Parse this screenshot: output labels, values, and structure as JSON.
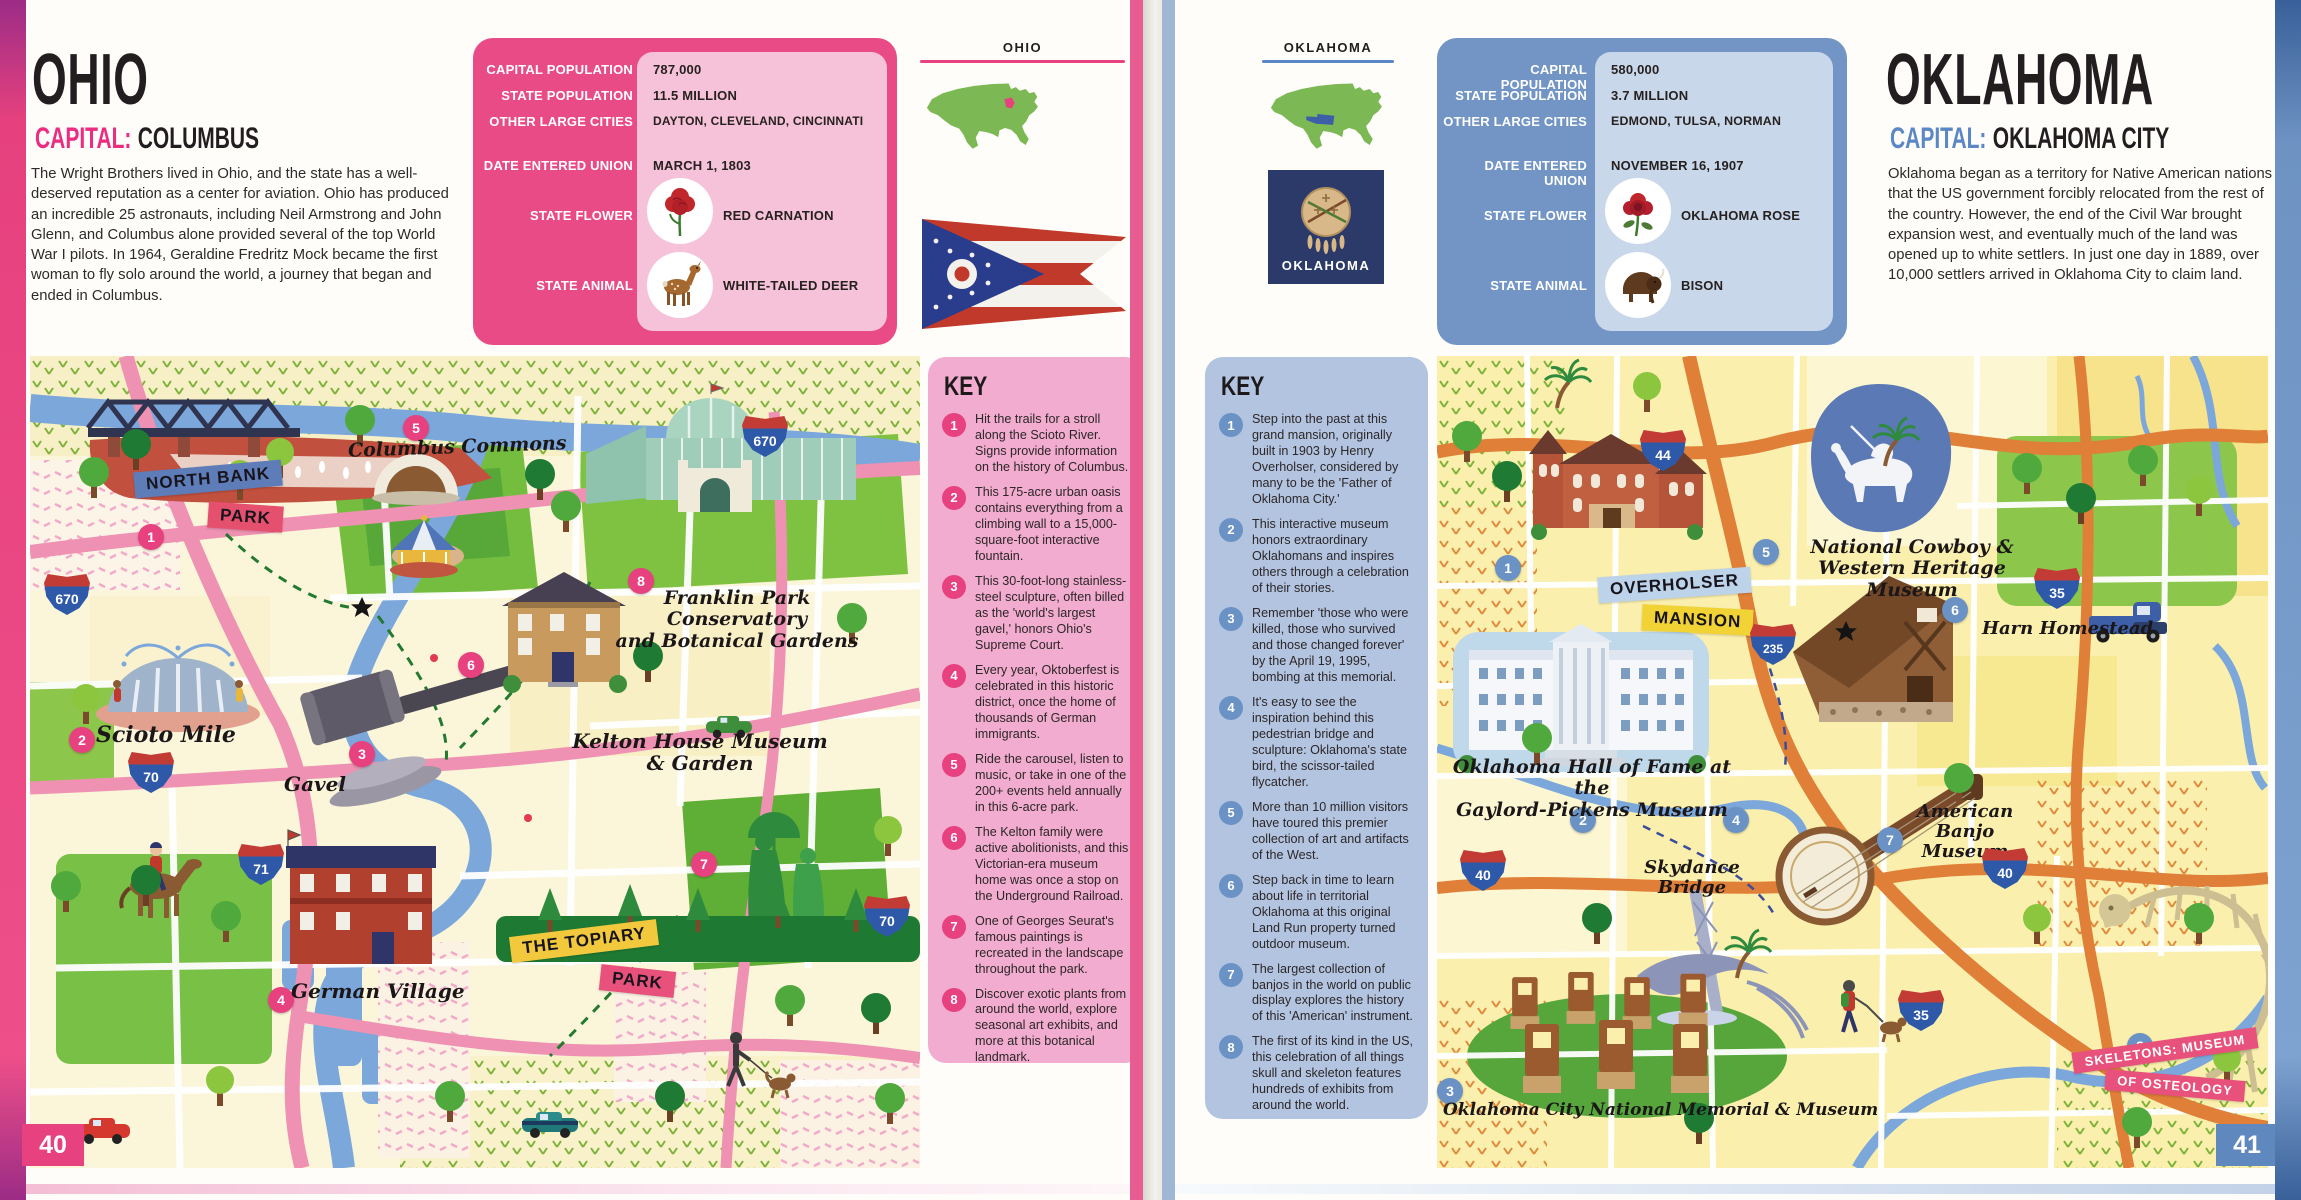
{
  "spread": {
    "left_page_number": "40",
    "right_page_number": "41"
  },
  "ohio": {
    "title": "OHIO",
    "capital_label": "CAPITAL:",
    "capital_name": "COLUMBUS",
    "state_tab": "OHIO",
    "accent_color": "#E8417F",
    "intro": "The Wright Brothers lived in Ohio, and the state has a well-deserved reputation as a center for aviation. Ohio has produced an incredible 25 astronauts, including Neil Armstrong and John Glenn, and Columbus alone provided several of the top World War I pilots. In 1964, Geraldine Fredritz Mock became the first woman to fly solo around the world, a journey that began and ended in Columbus.",
    "info_rows": [
      {
        "label": "CAPITAL POPULATION",
        "value": "787,000"
      },
      {
        "label": "STATE POPULATION",
        "value": "11.5 MILLION"
      },
      {
        "label": "OTHER LARGE CITIES",
        "value": "DAYTON, CLEVELAND, CINCINNATI"
      },
      {
        "label": "DATE ENTERED UNION",
        "value": "MARCH 1, 1803"
      },
      {
        "label": "STATE FLOWER",
        "value": "RED CARNATION",
        "icon": "carnation-icon"
      },
      {
        "label": "STATE ANIMAL",
        "value": "WHITE-TAILED DEER",
        "icon": "deer-icon"
      }
    ],
    "key": {
      "heading": "KEY",
      "items": [
        {
          "num": "1",
          "text": "Hit the trails for a stroll along the Scioto River. Signs provide information on the history of Columbus."
        },
        {
          "num": "2",
          "text": "This 175-acre urban oasis contains everything from a climbing wall to a 15,000-square-foot interactive fountain."
        },
        {
          "num": "3",
          "text": "This 30-foot-long stainless-steel sculpture, often billed as the 'world's largest gavel,' honors Ohio's Supreme Court."
        },
        {
          "num": "4",
          "text": "Every year, Oktoberfest is celebrated in this historic district, once the home of thousands of German immigrants."
        },
        {
          "num": "5",
          "text": "Ride the carousel, listen to music, or take in one of the 200+ events held annually in this 6-acre park."
        },
        {
          "num": "6",
          "text": "The Kelton family were active abolitionists, and this Victorian-era museum home was once a stop on the Underground Railroad."
        },
        {
          "num": "7",
          "text": "One of Georges Seurat's famous paintings is recreated in the landscape throughout the park."
        },
        {
          "num": "8",
          "text": "Discover exotic plants from around the world, explore seasonal art exhibits, and more at this botanical landmark."
        }
      ]
    },
    "map": {
      "north_bank_park": {
        "num": "1",
        "line1": "NORTH BANK",
        "line2": "PARK"
      },
      "scioto_mile": {
        "num": "2",
        "label": "Scioto Mile"
      },
      "gavel": {
        "num": "3",
        "label": "Gavel"
      },
      "german_village": {
        "num": "4",
        "label": "German Village"
      },
      "columbus_commons": {
        "num": "5",
        "label": "Columbus Commons"
      },
      "kelton_house": {
        "num": "6",
        "line1": "Kelton House Museum",
        "line2": "& Garden"
      },
      "topiary_park": {
        "num": "7",
        "line1": "THE TOPIARY",
        "line2": "PARK"
      },
      "franklin_park": {
        "num": "8",
        "line1": "Franklin Park Conservatory",
        "line2": "and Botanical Gardens"
      },
      "shields": {
        "i670a": "670",
        "i670b": "670",
        "i70a": "70",
        "i70b": "70",
        "i71": "71"
      }
    }
  },
  "oklahoma": {
    "title": "OKLAHOMA",
    "capital_label": "CAPITAL:",
    "capital_name": "OKLAHOMA CITY",
    "state_tab": "OKLAHOMA",
    "flag_text": "OKLAHOMA",
    "accent_color": "#7295C5",
    "intro": "Oklahoma began as a territory for Native American nations that the US government forcibly relocated from the rest of the country. However, the end of the Civil War brought expansion west, and eventually much of the land was opened up to white settlers. In just one day in 1889, over 10,000 settlers arrived in Oklahoma City to claim land.",
    "info_rows": [
      {
        "label": "CAPITAL POPULATION",
        "value": "580,000"
      },
      {
        "label": "STATE POPULATION",
        "value": "3.7 MILLION"
      },
      {
        "label": "OTHER LARGE CITIES",
        "value": "EDMOND, TULSA, NORMAN"
      },
      {
        "label": "DATE ENTERED UNION",
        "value": "NOVEMBER 16, 1907"
      },
      {
        "label": "STATE FLOWER",
        "value": "OKLAHOMA ROSE",
        "icon": "rose-icon"
      },
      {
        "label": "STATE ANIMAL",
        "value": "BISON",
        "icon": "bison-icon"
      }
    ],
    "key": {
      "heading": "KEY",
      "items": [
        {
          "num": "1",
          "text": "Step into the past at this grand mansion, originally built in 1903 by Henry Overholser, considered by many to be the 'Father of Oklahoma City.'"
        },
        {
          "num": "2",
          "text": "This interactive museum honors extraordinary Oklahomans and inspires others through a celebration of their stories."
        },
        {
          "num": "3",
          "text": "Remember 'those who were killed, those who survived and those changed forever' by the April 19, 1995, bombing at this memorial."
        },
        {
          "num": "4",
          "text": "It's easy to see the inspiration behind this pedestrian bridge and sculpture: Oklahoma's state bird, the scissor-tailed flycatcher."
        },
        {
          "num": "5",
          "text": "More than 10 million visitors have toured this premier collection of art and artifacts of the West."
        },
        {
          "num": "6",
          "text": "Step back in time to learn about life in territorial Oklahoma at this original Land Run property turned outdoor museum."
        },
        {
          "num": "7",
          "text": "The largest collection of banjos in the world on public display explores the history of this 'American' instrument."
        },
        {
          "num": "8",
          "text": "The first of its kind in the US, this celebration of all things skull and skeleton features hundreds of exhibits from around the world."
        }
      ]
    },
    "map": {
      "overholser": {
        "num": "1",
        "line1": "OVERHOLSER",
        "line2": "MANSION"
      },
      "hall_of_fame": {
        "num": "2",
        "line1": "Oklahoma Hall of Fame at the",
        "line2": "Gaylord-Pickens Museum"
      },
      "memorial": {
        "num": "3",
        "label": "Oklahoma City National Memorial & Museum"
      },
      "skydance": {
        "num": "4",
        "line1": "Skydance",
        "line2": "Bridge"
      },
      "cowboy": {
        "num": "5",
        "line1": "National Cowboy &",
        "line2": "Western Heritage Museum"
      },
      "harn": {
        "num": "6",
        "label": "Harn Homestead"
      },
      "banjo": {
        "num": "7",
        "line1": "American",
        "line2": "Banjo Museum"
      },
      "skeletons": {
        "num": "8",
        "line1": "SKELETONS: MUSEUM",
        "line2": "OF OSTEOLOGY"
      },
      "shields": {
        "i44": "44",
        "i235": "235",
        "i35a": "35",
        "i35b": "35",
        "i40a": "40",
        "i40b": "40"
      }
    }
  }
}
